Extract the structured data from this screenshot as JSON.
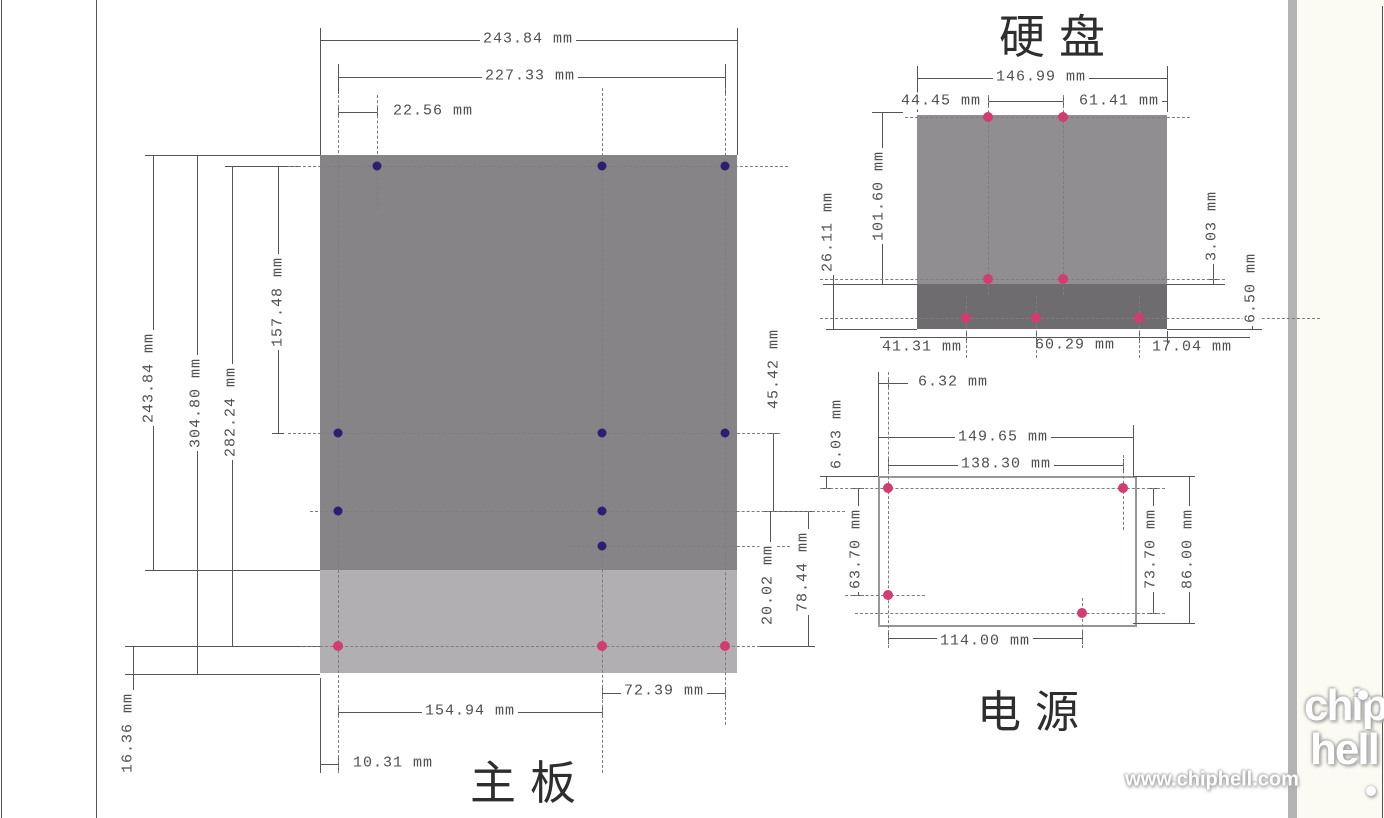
{
  "motherboard": {
    "title": "主板",
    "dims": {
      "width_outer": "243.84 mm",
      "width_holes": "227.33 mm",
      "hole_offset_top_left": "22.56 mm",
      "height_main": "243.84 mm",
      "height_full": "304.80 mm",
      "height_holes": "282.24 mm",
      "row1_to_row2": "157.48 mm",
      "row2_to_row3": "45.42 mm",
      "row3_to_row4": "20.02 mm",
      "row3_to_row5": "78.44 mm",
      "col2_to_col3": "72.39 mm",
      "col1_to_col2": "154.94 mm",
      "edge_to_col1": "10.31 mm",
      "row5_to_bottom_edge": "16.36 mm"
    }
  },
  "hdd": {
    "title": "硬盘",
    "dims": {
      "length": "146.99 mm",
      "top_hole_span": "44.45 mm",
      "top_hole_to_edge": "61.41 mm",
      "width": "101.60 mm",
      "side_height": "26.11 mm",
      "mid_hole_offset": "3.03 mm",
      "bottom_hole_offset": "6.50 mm",
      "bottom_edge_to_hole": "41.31 mm",
      "bottom_hole_span": "60.29 mm",
      "bottom_hole_to_edge": "17.04 mm"
    }
  },
  "psu": {
    "title": "电源",
    "dims": {
      "hole_inset_x": "6.32 mm",
      "hole_inset_y": "6.03 mm",
      "width_outer": "149.65 mm",
      "width_holes": "138.30 mm",
      "left_hole_span": "63.70 mm",
      "right_hole_span": "73.70 mm",
      "height": "86.00 mm",
      "bottom_hole_span": "114.00 mm"
    }
  },
  "watermark": {
    "url": "www.chiphell.com",
    "logo_top": "chip",
    "logo_bottom": "hell"
  },
  "colors": {
    "board_dark": "#868487",
    "board_light": "#b1afb2",
    "hdd_body": "#908e90",
    "hdd_strip": "#6e6c6e",
    "psu_border": "#98969a",
    "hole_navy": "#2e1e72",
    "hole_pink": "#d23c72",
    "dim_line": "#555555",
    "dash_line": "#7d7d7d",
    "frame_line": "#8a8a8a",
    "stripe": "#b5b3b5",
    "page_right_bg": "#fcfbf3"
  }
}
